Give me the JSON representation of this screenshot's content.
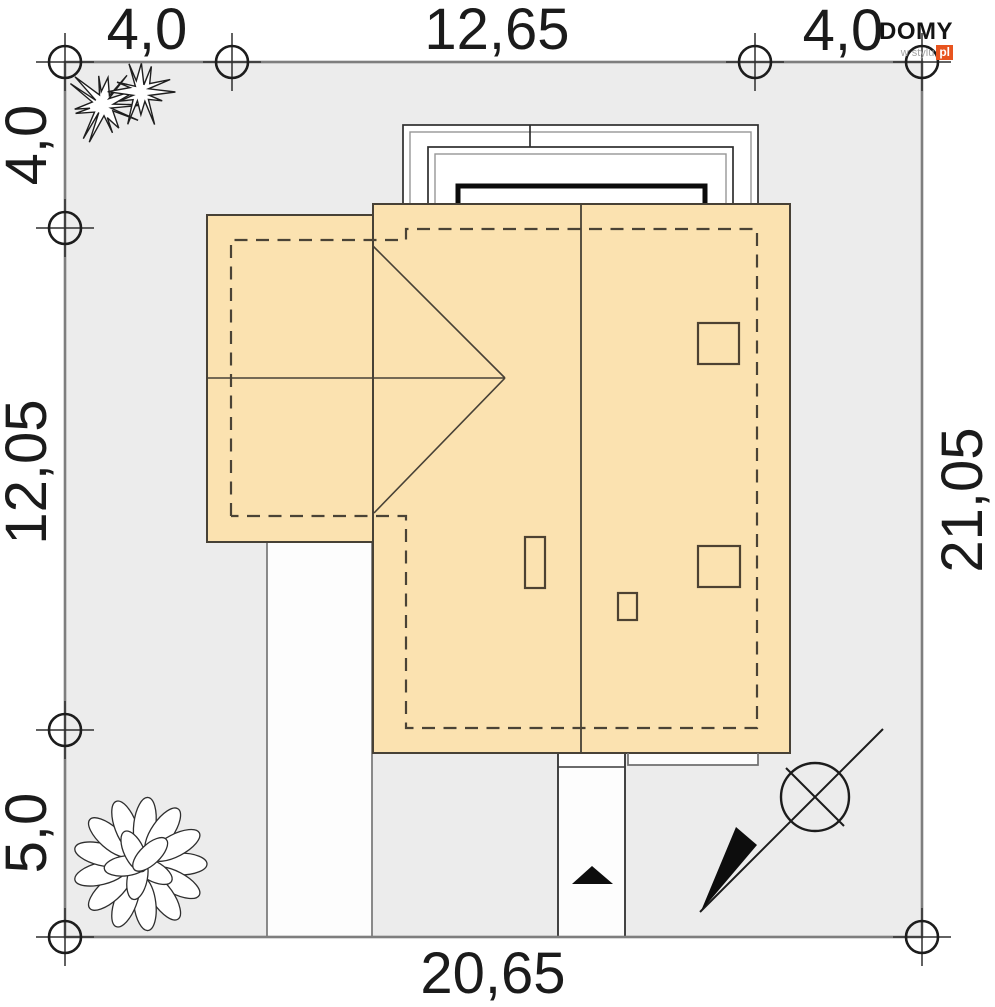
{
  "logo": {
    "brand": "DOMY",
    "tagline": "w stylu",
    "tld": "pl"
  },
  "dimensions": {
    "top_left": "4,0",
    "top_center": "12,65",
    "top_right": "4,0",
    "left_top": "4,0",
    "left_middle": "12,05",
    "left_bottom": "5,0",
    "right_side": "21,05",
    "bottom": "20,65"
  },
  "colors": {
    "house_fill": "#fbe2b0",
    "plot_fill": "#ececec",
    "boundary_gray": "#7e7e7e",
    "line_dark": "#474136",
    "logo_accent": "#e8541e"
  }
}
